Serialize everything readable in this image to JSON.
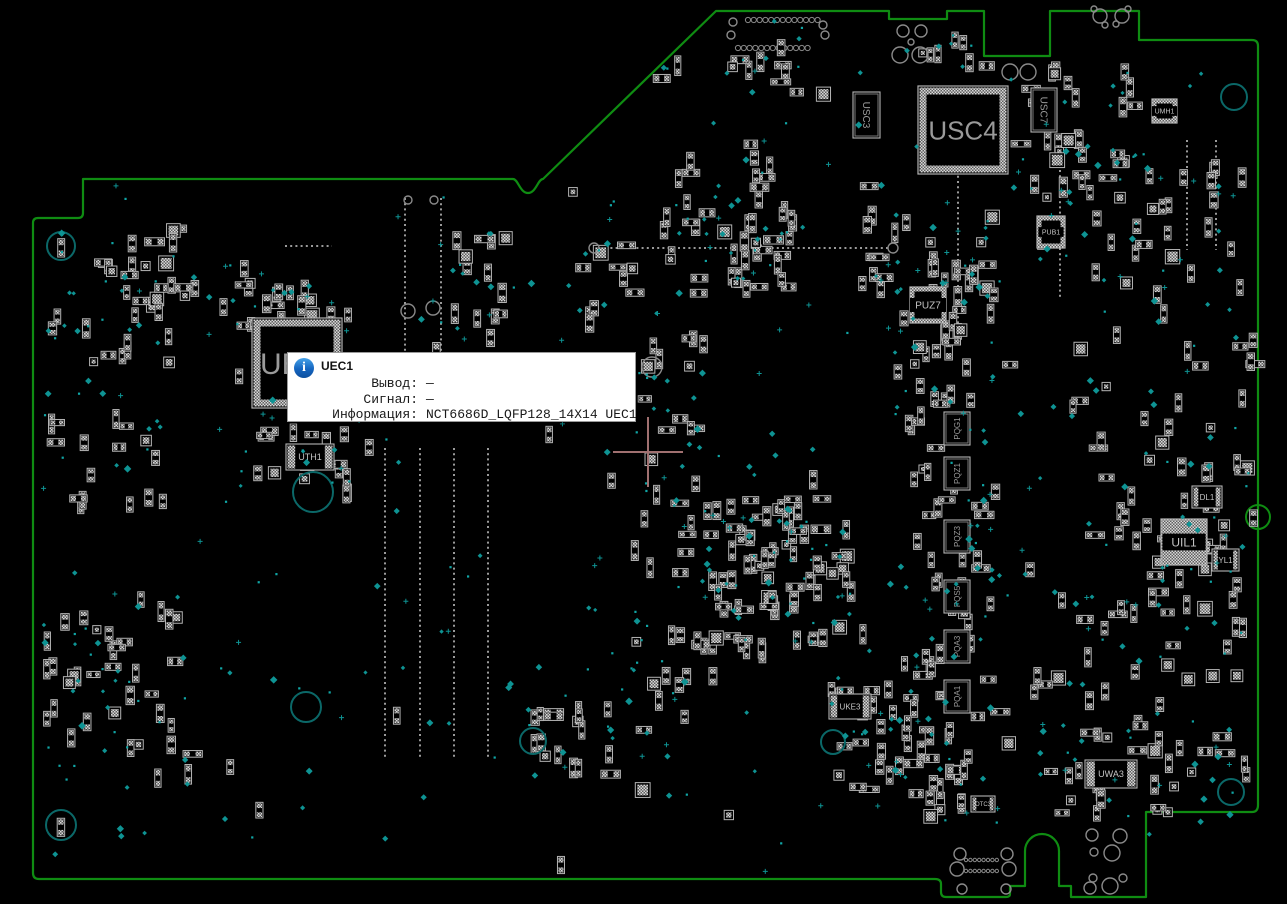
{
  "app_title": "BoardView",
  "tooltip": {
    "title": "UEC1",
    "rows": [
      {
        "label": "Вывод:",
        "value": "—"
      },
      {
        "label": "Сигнал:",
        "value": "—"
      },
      {
        "label": "Информация:",
        "value": "NCT6686D_LQFP128_14X14 UEC1"
      }
    ]
  },
  "colors": {
    "background": "#000000",
    "board_outline": "#0f8c12",
    "component_stroke": "#b4b4b4",
    "pad_light": "#d8d8d8",
    "pad_dark": "#5f5f5f",
    "testpoint": "#0e9393",
    "mount_hole": "#0b6868",
    "drill_circle": "#8a8a8a",
    "chip_label": "#9a9a9a",
    "slot_dotted": "#9a9a9a",
    "crosshair": "#a07070",
    "tooltip_accent": "#1565c0"
  },
  "board": {
    "components": [
      {
        "ref": "UEC1",
        "type": "qfp",
        "x": 252,
        "y": 318,
        "w": 90,
        "h": 90,
        "fs": 30,
        "anchor": "left"
      },
      {
        "ref": "USC4",
        "type": "qfp",
        "x": 918,
        "y": 86,
        "w": 90,
        "h": 88,
        "fs": 26
      },
      {
        "ref": "USC3",
        "type": "vchip",
        "x": 853,
        "y": 92,
        "w": 27,
        "h": 46,
        "fs": 10,
        "rot": 90
      },
      {
        "ref": "USC7",
        "type": "vchip",
        "x": 1031,
        "y": 88,
        "w": 26,
        "h": 44,
        "fs": 10,
        "rot": 90
      },
      {
        "ref": "PUZ7",
        "type": "qfn",
        "x": 910,
        "y": 287,
        "w": 36,
        "h": 36,
        "fs": 10
      },
      {
        "ref": "PUB1",
        "type": "qfn",
        "x": 1037,
        "y": 216,
        "w": 28,
        "h": 32,
        "fs": 7
      },
      {
        "ref": "UMH1",
        "type": "qfn",
        "x": 1152,
        "y": 99,
        "w": 25,
        "h": 24,
        "fs": 7
      },
      {
        "ref": "UTH1",
        "type": "rchip",
        "x": 286,
        "y": 444,
        "w": 48,
        "h": 26,
        "fs": 9
      },
      {
        "ref": "PQG1",
        "type": "vchip",
        "x": 944,
        "y": 412,
        "w": 26,
        "h": 33,
        "fs": 8,
        "rot": -90
      },
      {
        "ref": "PQZ1",
        "type": "vchip",
        "x": 944,
        "y": 457,
        "w": 26,
        "h": 33,
        "fs": 8,
        "rot": -90
      },
      {
        "ref": "PQZ3",
        "type": "vchip",
        "x": 944,
        "y": 520,
        "w": 26,
        "h": 33,
        "fs": 8,
        "rot": -90
      },
      {
        "ref": "PQS5",
        "type": "vchip",
        "x": 944,
        "y": 580,
        "w": 26,
        "h": 33,
        "fs": 8,
        "rot": -90
      },
      {
        "ref": "PQA3",
        "type": "vchip",
        "x": 944,
        "y": 630,
        "w": 26,
        "h": 33,
        "fs": 8,
        "rot": -90
      },
      {
        "ref": "PQA1",
        "type": "vchip",
        "x": 944,
        "y": 680,
        "w": 26,
        "h": 33,
        "fs": 8,
        "rot": -90
      },
      {
        "ref": "UIL1",
        "type": "qfnf",
        "x": 1161,
        "y": 519,
        "w": 46,
        "h": 46,
        "fs": 12
      },
      {
        "ref": "DL1",
        "type": "rchip",
        "x": 1192,
        "y": 486,
        "w": 30,
        "h": 22,
        "fs": 8
      },
      {
        "ref": "YL1",
        "type": "rchip",
        "x": 1212,
        "y": 549,
        "w": 27,
        "h": 22,
        "fs": 8
      },
      {
        "ref": "UKE3",
        "type": "rchip",
        "x": 829,
        "y": 694,
        "w": 42,
        "h": 25,
        "fs": 8
      },
      {
        "ref": "OTC3",
        "type": "rchip",
        "x": 971,
        "y": 796,
        "w": 24,
        "h": 16,
        "fs": 6
      },
      {
        "ref": "UWA3",
        "type": "rchip",
        "x": 1085,
        "y": 760,
        "w": 52,
        "h": 28,
        "fs": 9
      }
    ]
  }
}
